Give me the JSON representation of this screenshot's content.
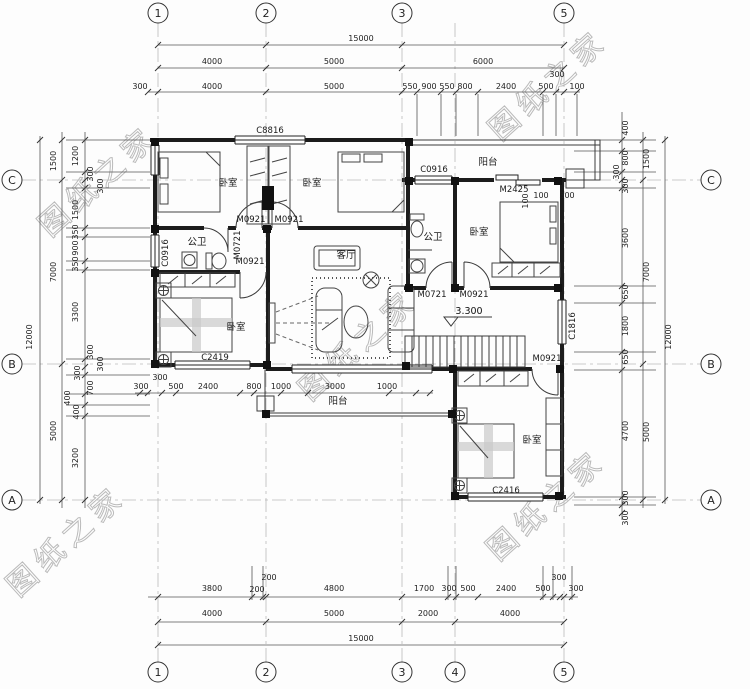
{
  "watermark": {
    "text": "图纸之家",
    "color": "#8f8f8f"
  },
  "level_mark": "3.300",
  "grid": {
    "bubbles": [
      {
        "l": "1",
        "x": 158,
        "y": 13
      },
      {
        "l": "2",
        "x": 266,
        "y": 13
      },
      {
        "l": "3",
        "x": 402,
        "y": 13
      },
      {
        "l": "5",
        "x": 564,
        "y": 13
      },
      {
        "l": "1",
        "x": 158,
        "y": 672
      },
      {
        "l": "2",
        "x": 266,
        "y": 672
      },
      {
        "l": "3",
        "x": 402,
        "y": 672
      },
      {
        "l": "4",
        "x": 455,
        "y": 672
      },
      {
        "l": "5",
        "x": 564,
        "y": 672
      },
      {
        "l": "C",
        "x": 12,
        "y": 180
      },
      {
        "l": "B",
        "x": 12,
        "y": 364
      },
      {
        "l": "A",
        "x": 12,
        "y": 500
      },
      {
        "l": "C",
        "x": 711,
        "y": 180
      },
      {
        "l": "B",
        "x": 711,
        "y": 364
      },
      {
        "l": "A",
        "x": 711,
        "y": 500
      }
    ]
  },
  "annotations": [
    {
      "t": "15000",
      "x": 361,
      "y": 41
    },
    {
      "t": "4000",
      "x": 212,
      "y": 64
    },
    {
      "t": "5000",
      "x": 334,
      "y": 64
    },
    {
      "t": "6000",
      "x": 483,
      "y": 64
    },
    {
      "t": "300",
      "x": 140,
      "y": 89
    },
    {
      "t": "4000",
      "x": 212,
      "y": 89
    },
    {
      "t": "5000",
      "x": 334,
      "y": 89
    },
    {
      "t": "550",
      "x": 410,
      "y": 89
    },
    {
      "t": "900",
      "x": 429,
      "y": 89
    },
    {
      "t": "550",
      "x": 447,
      "y": 89
    },
    {
      "t": "800",
      "x": 465,
      "y": 89
    },
    {
      "t": "2400",
      "x": 506,
      "y": 89
    },
    {
      "t": "500",
      "x": 546,
      "y": 89
    },
    {
      "t": "300",
      "x": 557,
      "y": 77
    },
    {
      "t": "100",
      "x": 577,
      "y": 89
    },
    {
      "t": "3800",
      "x": 212,
      "y": 591
    },
    {
      "t": "200",
      "x": 257,
      "y": 592
    },
    {
      "t": "200",
      "x": 269,
      "y": 580
    },
    {
      "t": "4800",
      "x": 334,
      "y": 591
    },
    {
      "t": "1700",
      "x": 424,
      "y": 591
    },
    {
      "t": "300",
      "x": 449,
      "y": 591
    },
    {
      "t": "500",
      "x": 468,
      "y": 591
    },
    {
      "t": "2400",
      "x": 506,
      "y": 591
    },
    {
      "t": "500",
      "x": 543,
      "y": 591
    },
    {
      "t": "300",
      "x": 559,
      "y": 580
    },
    {
      "t": "300",
      "x": 576,
      "y": 591
    },
    {
      "t": "4000",
      "x": 212,
      "y": 616
    },
    {
      "t": "5000",
      "x": 334,
      "y": 616
    },
    {
      "t": "2000",
      "x": 428,
      "y": 616
    },
    {
      "t": "4000",
      "x": 510,
      "y": 616
    },
    {
      "t": "15000",
      "x": 361,
      "y": 641
    },
    {
      "t": "1200",
      "x": 78,
      "y": 156,
      "r": -90
    },
    {
      "t": "300",
      "x": 93,
      "y": 174,
      "r": -90
    },
    {
      "t": "300",
      "x": 103,
      "y": 186,
      "r": -90
    },
    {
      "t": "1500",
      "x": 78,
      "y": 210,
      "r": -90
    },
    {
      "t": "350",
      "x": 78,
      "y": 232,
      "r": -90
    },
    {
      "t": "900",
      "x": 78,
      "y": 248,
      "r": -90
    },
    {
      "t": "350",
      "x": 78,
      "y": 264,
      "r": -90
    },
    {
      "t": "3300",
      "x": 78,
      "y": 312,
      "r": -90
    },
    {
      "t": "300",
      "x": 93,
      "y": 352,
      "r": -90
    },
    {
      "t": "300",
      "x": 103,
      "y": 364,
      "r": -90
    },
    {
      "t": "300",
      "x": 80,
      "y": 373,
      "r": -90
    },
    {
      "t": "700",
      "x": 93,
      "y": 388,
      "r": -90
    },
    {
      "t": "400",
      "x": 70,
      "y": 398,
      "r": -90
    },
    {
      "t": "400",
      "x": 79,
      "y": 412,
      "r": -90
    },
    {
      "t": "3200",
      "x": 78,
      "y": 458,
      "r": -90
    },
    {
      "t": "1500",
      "x": 56,
      "y": 161,
      "r": -90
    },
    {
      "t": "7000",
      "x": 56,
      "y": 272,
      "r": -90
    },
    {
      "t": "5000",
      "x": 56,
      "y": 431,
      "r": -90
    },
    {
      "t": "12000",
      "x": 32,
      "y": 337,
      "r": -90
    },
    {
      "t": "400",
      "x": 628,
      "y": 128,
      "r": -90
    },
    {
      "t": "800",
      "x": 628,
      "y": 158,
      "r": -90
    },
    {
      "t": "300",
      "x": 619,
      "y": 172,
      "r": -90
    },
    {
      "t": "300",
      "x": 628,
      "y": 186,
      "r": -90
    },
    {
      "t": "3600",
      "x": 628,
      "y": 238,
      "r": -90
    },
    {
      "t": "650",
      "x": 628,
      "y": 292,
      "r": -90
    },
    {
      "t": "1800",
      "x": 628,
      "y": 326,
      "r": -90
    },
    {
      "t": "650",
      "x": 628,
      "y": 357,
      "r": -90
    },
    {
      "t": "4700",
      "x": 628,
      "y": 431,
      "r": -90
    },
    {
      "t": "300",
      "x": 628,
      "y": 498,
      "r": -90
    },
    {
      "t": "300",
      "x": 628,
      "y": 518,
      "r": -90
    },
    {
      "t": "1500",
      "x": 649,
      "y": 159,
      "r": -90
    },
    {
      "t": "7000",
      "x": 649,
      "y": 272,
      "r": -90
    },
    {
      "t": "5000",
      "x": 649,
      "y": 432,
      "r": -90
    },
    {
      "t": "12000",
      "x": 671,
      "y": 337,
      "r": -90
    },
    {
      "t": "300",
      "x": 141,
      "y": 389
    },
    {
      "t": "300",
      "x": 160,
      "y": 380
    },
    {
      "t": "500",
      "x": 176,
      "y": 389
    },
    {
      "t": "2400",
      "x": 208,
      "y": 389
    },
    {
      "t": "800",
      "x": 254,
      "y": 389
    },
    {
      "t": "1000",
      "x": 281,
      "y": 389
    },
    {
      "t": "3000",
      "x": 335,
      "y": 389
    },
    {
      "t": "1000",
      "x": 387,
      "y": 389
    },
    {
      "t": "100",
      "x": 528,
      "y": 201,
      "r": -90
    },
    {
      "t": "100",
      "x": 541,
      "y": 198
    },
    {
      "t": "300",
      "x": 567,
      "y": 198
    },
    {
      "t": "C8816",
      "x": 270,
      "y": 133,
      "cls": "code",
      "n": "window-code"
    },
    {
      "t": "C0916",
      "x": 168,
      "y": 253,
      "r": -90,
      "cls": "code",
      "n": "window-code"
    },
    {
      "t": "M0921",
      "x": 251,
      "y": 222,
      "cls": "code",
      "n": "door-code"
    },
    {
      "t": "M0921",
      "x": 289,
      "y": 222,
      "cls": "code",
      "n": "door-code"
    },
    {
      "t": "M0721",
      "x": 240,
      "y": 245,
      "r": -90,
      "cls": "code",
      "n": "door-code"
    },
    {
      "t": "M0921",
      "x": 250,
      "y": 264,
      "cls": "code",
      "n": "door-code"
    },
    {
      "t": "C0916",
      "x": 434,
      "y": 172,
      "cls": "code",
      "n": "window-code"
    },
    {
      "t": "M2425",
      "x": 514,
      "y": 192,
      "cls": "code",
      "n": "door-code"
    },
    {
      "t": "M0721",
      "x": 432,
      "y": 297,
      "cls": "code",
      "n": "door-code"
    },
    {
      "t": "M0921",
      "x": 474,
      "y": 297,
      "cls": "code",
      "n": "door-code"
    },
    {
      "t": "C1816",
      "x": 575,
      "y": 326,
      "r": -90,
      "cls": "code",
      "n": "window-code"
    },
    {
      "t": "M0921",
      "x": 547,
      "y": 361,
      "cls": "code",
      "n": "door-code"
    },
    {
      "t": "C2419",
      "x": 215,
      "y": 360,
      "cls": "code",
      "n": "window-code"
    },
    {
      "t": "C2416",
      "x": 506,
      "y": 493,
      "cls": "code",
      "n": "window-code"
    },
    {
      "t": "3.300",
      "x": 469,
      "y": 314,
      "cls": "lvl",
      "n": "level-mark"
    },
    {
      "t": "卧室",
      "x": 228,
      "y": 186,
      "cls": "room",
      "n": "room-label-bedroom"
    },
    {
      "t": "卧室",
      "x": 312,
      "y": 186,
      "cls": "room",
      "n": "room-label-bedroom"
    },
    {
      "t": "公卫",
      "x": 197,
      "y": 245,
      "cls": "room",
      "n": "room-label-bathroom"
    },
    {
      "t": "阳台",
      "x": 488,
      "y": 165,
      "cls": "room",
      "n": "room-label-balcony"
    },
    {
      "t": "公卫",
      "x": 433,
      "y": 240,
      "cls": "room",
      "n": "room-label-bathroom"
    },
    {
      "t": "卧室",
      "x": 479,
      "y": 235,
      "cls": "room",
      "n": "room-label-bedroom"
    },
    {
      "t": "客厅",
      "x": 346,
      "y": 258,
      "cls": "room",
      "n": "room-label-livingroom"
    },
    {
      "t": "卧室",
      "x": 236,
      "y": 330,
      "cls": "room",
      "n": "room-label-bedroom"
    },
    {
      "t": "阳台",
      "x": 338,
      "y": 404,
      "cls": "room",
      "n": "room-label-balcony"
    },
    {
      "t": "卧室",
      "x": 532,
      "y": 443,
      "cls": "room",
      "n": "room-label-bedroom"
    }
  ]
}
